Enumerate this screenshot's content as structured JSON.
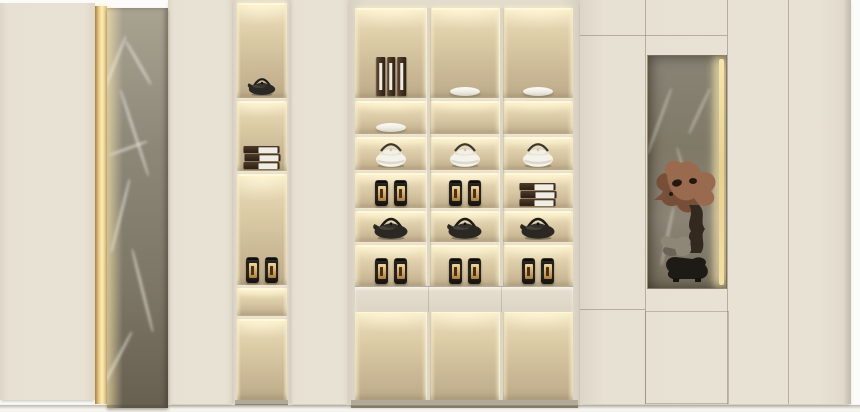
{
  "scene": {
    "description": "Cream built-in display cabinet wall with warm illuminated niches holding tea ware, a back-lit grey marble pillar, and a marble-backed niche with a driftwood root sculpture",
    "wall_color": "#fcfbf9",
    "floor_color": "#f6f4ef"
  },
  "colors": {
    "panel_cream": "#e7e1d4",
    "frame_cream": "#e3dccd",
    "shelf_face": "#d9d2c1",
    "niche_glow": "#fff3d0",
    "niche_mid": "#cfbd9a",
    "niche_dark": "#bcab89",
    "gold_light_strip": "#ffedb4",
    "marble_grey": "#8d8778",
    "marble_dark": "#675f4f",
    "object_dark": "#29241f",
    "object_brown": "#42301f",
    "gold_label": "#d2a964",
    "porcelain": "#f6f3ec",
    "sculpture_brown": "#9a6a4e",
    "sculpture_grey": "#8e8778",
    "base_shadow": "#b2aa99"
  },
  "panels": [
    {
      "name": "left-door-panel",
      "x": 0,
      "y": 3,
      "w": 95,
      "h": 397
    },
    {
      "name": "left-return-panel",
      "x": 168,
      "y": 0,
      "w": 65,
      "h": 404
    },
    {
      "name": "mid-spacer-panel",
      "x": 290,
      "y": 0,
      "w": 59,
      "h": 404
    }
  ],
  "accent": {
    "light_strip": {
      "x": 95,
      "y": 6,
      "w": 12,
      "h": 398
    },
    "marble_pillar": {
      "x": 107,
      "y": 8,
      "w": 61,
      "h": 400
    }
  },
  "tall_column": {
    "frame": {
      "x": 233,
      "y": 0,
      "w": 57,
      "h": 404
    },
    "inner_x": 4,
    "inner_w": 50,
    "shelves": [
      {
        "name": "column-shelf-1",
        "y": 3,
        "h": 95,
        "item": "teapot-dark-small"
      },
      {
        "name": "column-shelf-2",
        "y": 101,
        "h": 70,
        "item": "box-stack"
      },
      {
        "name": "column-shelf-3",
        "y": 174,
        "h": 111,
        "item": "canister-pair"
      },
      {
        "name": "column-shelf-4",
        "y": 288,
        "h": 28,
        "item": "none"
      },
      {
        "name": "column-shelf-5",
        "y": 319,
        "h": 81,
        "item": "none"
      }
    ]
  },
  "display_unit": {
    "frame": {
      "x": 349,
      "y": 0,
      "w": 231,
      "h": 406
    },
    "inner_x": 6,
    "inner_w": 218,
    "columns": [
      {
        "x": 6,
        "w": 72
      },
      {
        "x": 81,
        "w": 70
      },
      {
        "x": 154,
        "w": 70
      }
    ],
    "divider_xs": [
      78,
      151
    ],
    "rows": [
      {
        "name": "row-1",
        "y": 8,
        "h": 90,
        "cells": [
          "book-set-vertical",
          "bowl-white",
          "bowl-white"
        ]
      },
      {
        "name": "row-2",
        "y": 101,
        "h": 33,
        "cells": [
          "bowl-white",
          "none",
          "none"
        ]
      },
      {
        "name": "row-3",
        "y": 137,
        "h": 33,
        "cells": [
          "teapot-white",
          "teapot-white",
          "teapot-white"
        ]
      },
      {
        "name": "row-4",
        "y": 173,
        "h": 35,
        "cells": [
          "canister-pair",
          "canister-pair",
          "box-stack"
        ]
      },
      {
        "name": "row-5",
        "y": 211,
        "h": 31,
        "cells": [
          "teapot-dark",
          "teapot-dark",
          "teapot-dark"
        ]
      },
      {
        "name": "row-6",
        "y": 245,
        "h": 41,
        "cells": [
          "canister-pair",
          "canister-pair",
          "canister-pair"
        ]
      },
      {
        "name": "row-7",
        "y": 311,
        "h": 89,
        "cells": [
          "none",
          "none",
          "none"
        ]
      }
    ],
    "drawer_band": {
      "y": 286,
      "h": 25
    },
    "base": {
      "y": 400,
      "h": 6
    }
  },
  "right_section": {
    "panel": {
      "x": 580,
      "y": 0,
      "w": 271,
      "h": 404
    },
    "seams_v": [
      645,
      727,
      788
    ],
    "seams_h": [
      {
        "y": 35,
        "x1": 580,
        "x2": 727
      },
      {
        "y": 309,
        "x1": 580,
        "x2": 645
      }
    ],
    "door_rect": {
      "x": 645,
      "y": 311,
      "w": 82,
      "h": 91
    },
    "niche": {
      "x": 647,
      "y": 55,
      "w": 78,
      "h": 232
    },
    "sculpture": "driftwood-root-sculpture"
  },
  "items_catalog": {
    "teapot-dark": "black cast-iron teapot",
    "teapot-dark-small": "black cast-iron teapot (small)",
    "teapot-white": "white porcelain teapot with arched handle",
    "bowl-white": "white porcelain bowl",
    "canister-pair": "pair of dark tea canisters with gold labels",
    "box-stack": "stack of three dark tea gift boxes with white labels",
    "book-set-vertical": "three upright dark tea boxes with white spine labels",
    "driftwood-root-sculpture": "gnarled driftwood root sculpture on black stand"
  }
}
